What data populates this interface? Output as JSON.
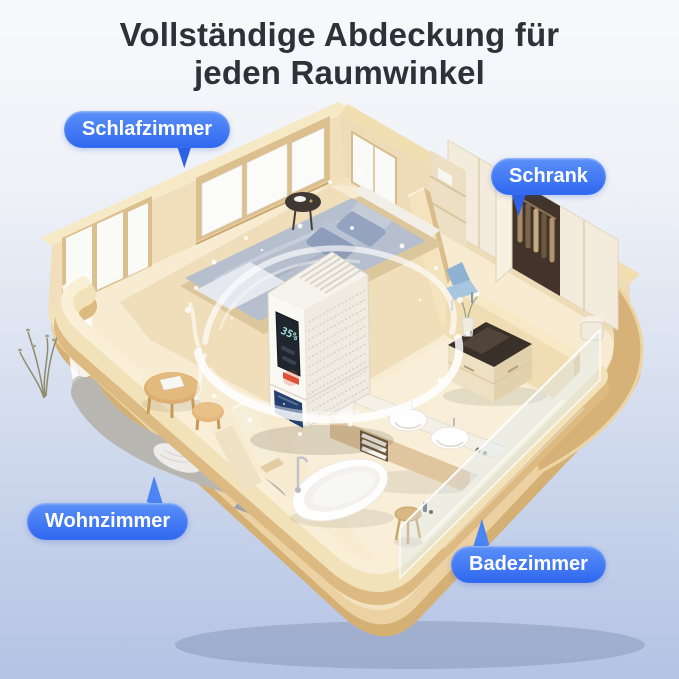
{
  "title": {
    "line1": "Vollständige Abdeckung für",
    "line2": "jeden Raumwinkel"
  },
  "callouts": {
    "schlafzimmer": {
      "label": "Schlafzimmer"
    },
    "schrank": {
      "label": "Schrank"
    },
    "wohnzimmer": {
      "label": "Wohnzimmer"
    },
    "badezimmer": {
      "label": "Badezimmer"
    }
  },
  "device": {
    "display_value": "35%"
  },
  "colors": {
    "accent_blue": "#3672F1",
    "label_text": "#FFFFFF",
    "title_text": "#2D3138",
    "background_top": "#F7F8FB",
    "background_bottom": "#B3C3E4",
    "wall_tan": "#E9D3A5",
    "floor_cream": "#F6ECD1"
  }
}
